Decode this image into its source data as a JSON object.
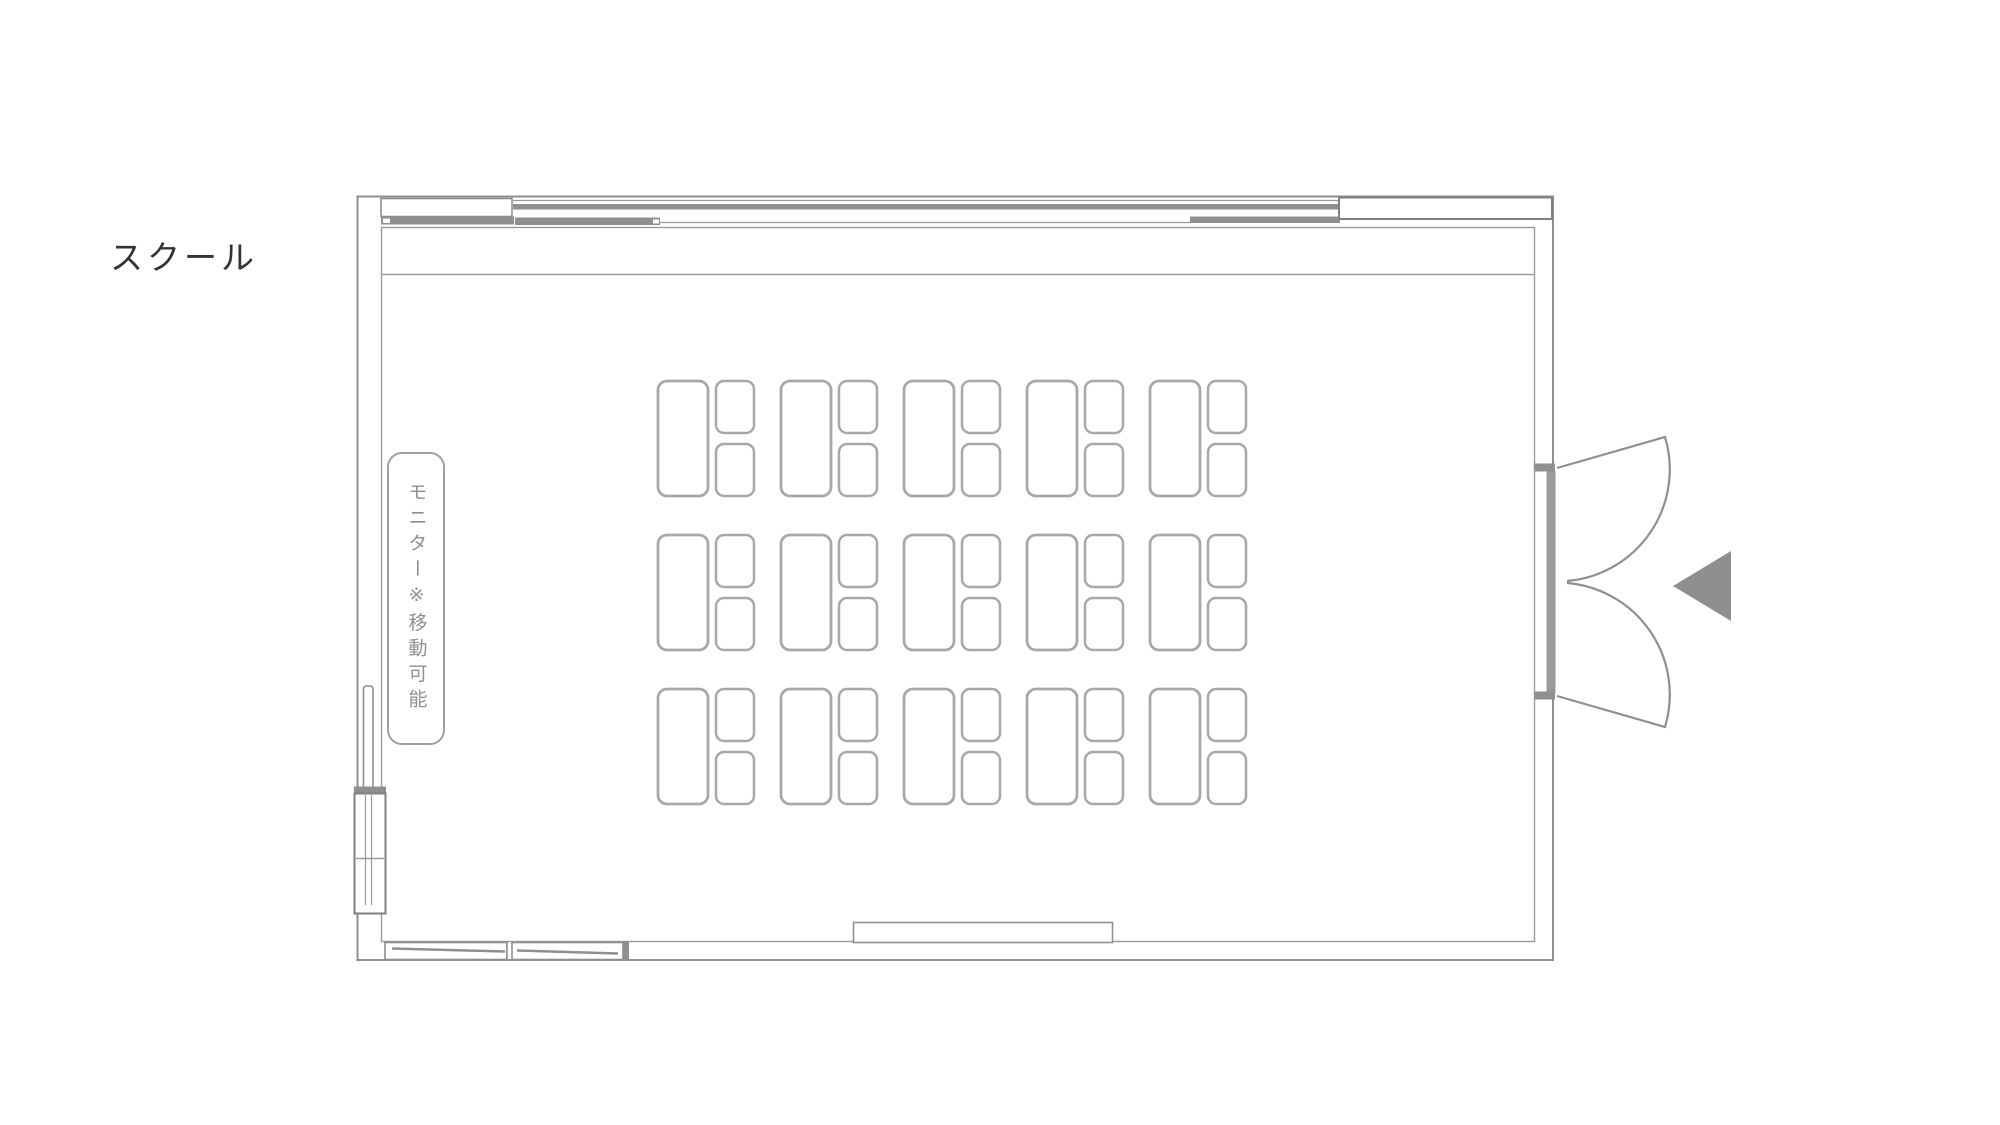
{
  "floor_plan": {
    "layout_name": "スクール",
    "monitor_note": "モニター※移動可能",
    "seating": {
      "rows": 3,
      "columns": 5,
      "chairs_per_desk": 2,
      "total_desks": 15,
      "total_chairs": 30
    },
    "door": {
      "type": "double-swing",
      "position": "right-wall",
      "arrow_direction": "left"
    },
    "colors": {
      "wall_line": "#8f8f8f",
      "furniture_line": "#a8a8a8",
      "title_text": "#333333",
      "note_text": "#8f8f8f",
      "door_arrow": "#8f8f8f",
      "background": "#ffffff"
    }
  }
}
